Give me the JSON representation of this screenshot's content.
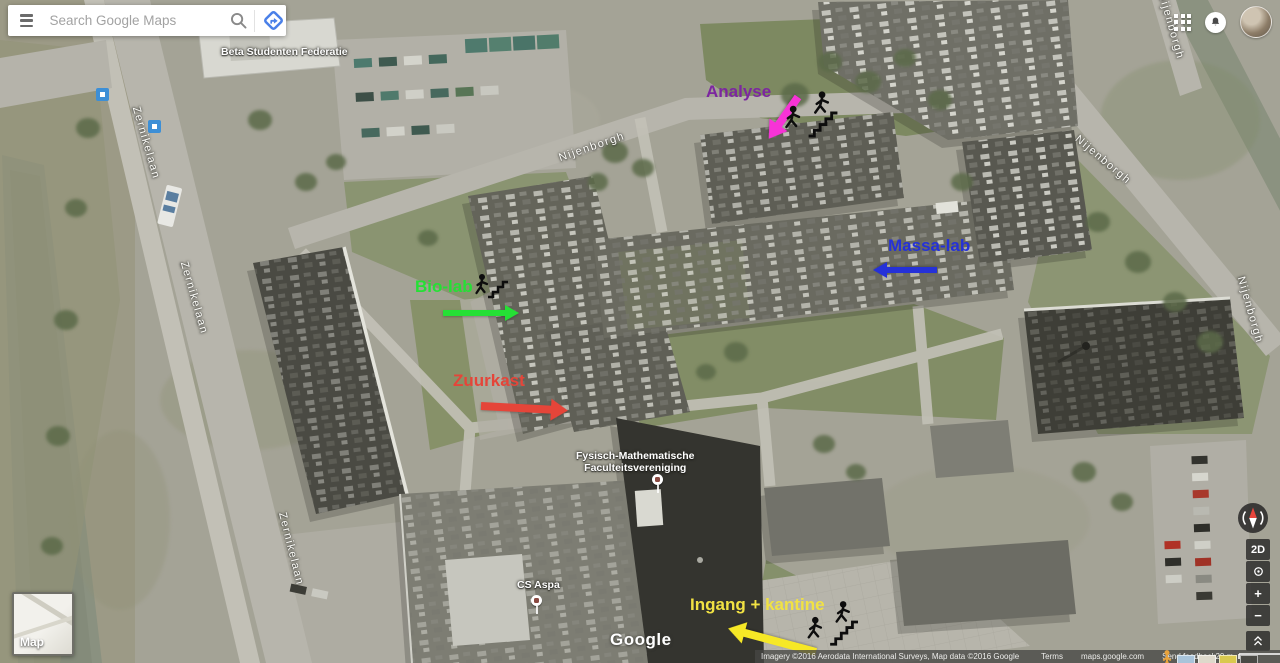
{
  "app_title": "Google Maps",
  "search": {
    "placeholder": "Search Google Maps"
  },
  "map": {
    "poi": [
      {
        "text": "Beta Studenten Federatie"
      },
      {
        "line1": "Fysisch-Mathematische",
        "line2": "Faculteitsvereniging"
      },
      {
        "text": "CS Aspa"
      }
    ],
    "streets": [
      "Zernikelaan",
      "Zernikelaan",
      "Zernikelaan",
      "Nijenborgh",
      "Nijenborgh",
      "Nijenborgh",
      "Nijenborgh"
    ],
    "annotations": [
      {
        "label": "Analyse",
        "text_color": "#7c26a0",
        "arrow_color": "#f733d6",
        "arrow_direction": "down-left",
        "icon": "person-climbing-stairs"
      },
      {
        "label": "Massa-lab",
        "text_color": "#2531d8",
        "arrow_color": "#2531d8",
        "arrow_direction": "left",
        "icon": null
      },
      {
        "label": "Bio-lab",
        "text_color": "#25e035",
        "arrow_color": "#25e035",
        "arrow_direction": "right",
        "icon": "person-climbing-stairs"
      },
      {
        "label": "Zuurkast",
        "text_color": "#e54539",
        "arrow_color": "#e54539",
        "arrow_direction": "right",
        "icon": null
      },
      {
        "label": "Ingang + kantine",
        "text_color": "#f1e243",
        "arrow_color": "#f6e826",
        "arrow_direction": "up-left",
        "icon": "person-climbing-stairs"
      }
    ],
    "watermark": "Google"
  },
  "controls": {
    "map_preview_label": "Map",
    "view_2d": "2D",
    "zoom_in": "+",
    "zoom_out": "−"
  },
  "footer": {
    "attribution": "Imagery ©2016 Aerodata International Surveys, Map data ©2016 Google",
    "terms": "Terms",
    "site": "maps.google.com",
    "feedback": "Send feedback",
    "scale": "20 m"
  },
  "icons": {
    "menu": "hamburger",
    "search": "magnifier",
    "directions": "blue-diamond-arrow",
    "apps": "grid-3x3",
    "notifications": "bell",
    "compass": "compass-needle",
    "my_location": "target-dot",
    "expand": "double-chevron-up",
    "pegman": "orange-person",
    "stairs": "person-climbing-stairs",
    "poi_marker": "dot-in-circle"
  }
}
